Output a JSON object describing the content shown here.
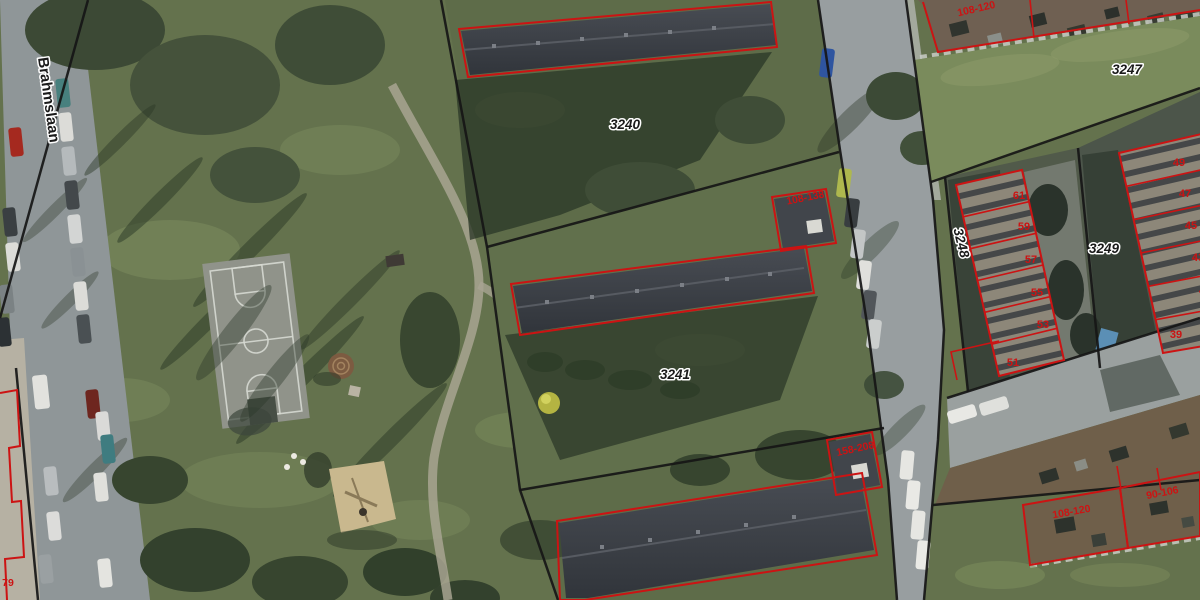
{
  "map": {
    "street": {
      "name": "Brahmslaan"
    },
    "parcels": {
      "p3240": "3240",
      "p3241": "3241",
      "p3247": "3247",
      "p3248": "3248",
      "p3249": "3249"
    },
    "house_numbers": {
      "west": [
        "61",
        "59",
        "57",
        "55",
        "53",
        "51"
      ],
      "east": [
        "49",
        "47",
        "45",
        "43",
        "41",
        "39"
      ]
    },
    "address_ranges": {
      "north_gardens": "108-120",
      "middle_annex": "108-138",
      "south_annex": "158-208",
      "south_gardens_west": "108-120",
      "south_gardens_east": "90-106",
      "west_edge_partial": "79"
    },
    "colors": {
      "cadastral-red": "#cc1313",
      "boundary-black": "#161616",
      "label-black": "#1a1a1a",
      "label-halo": "#ffffff"
    }
  }
}
